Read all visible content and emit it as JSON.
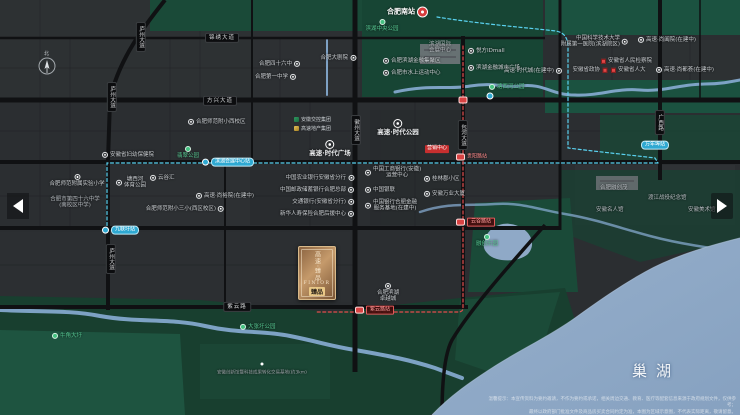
{
  "map": {
    "lake": "巢湖",
    "compass": "北",
    "disclaimer1": "温馨提示：本宣传资料为要约邀请，不作为要约或承诺，相关周边交通、教育、医疗等配套信息来源于政府规划文件，仅供参考；",
    "disclaimer2": "最终以政府部门批准文件及商品房买卖合同约定为准，本图为区域示意图，不代表实际距离，敬请留意。"
  },
  "project_card": {
    "vertical": "高速·臻品",
    "latin": "FINIOR",
    "badge": "臻品"
  },
  "legend": [
    {
      "icon": "green",
      "text": "安徽交控集团"
    },
    {
      "icon": "gold",
      "text": "高速地产集团"
    }
  ],
  "labels": [
    {
      "t": "rail",
      "a": "r",
      "x": 428,
      "y": 12,
      "text": "合肥南站"
    },
    {
      "t": "park-below",
      "a": "c",
      "x": 382,
      "y": 19,
      "text": "滨湖中央公园"
    },
    {
      "t": "park",
      "a": "l",
      "x": 489,
      "y": 87,
      "text": "塘西河公园"
    },
    {
      "t": "park-below",
      "a": "c",
      "x": 188,
      "y": 146,
      "text": "翡翠公园"
    },
    {
      "t": "park-below",
      "a": "c",
      "x": 487,
      "y": 234,
      "text": "融创乐园"
    },
    {
      "t": "park",
      "a": "l",
      "x": 240,
      "y": 327,
      "text": "大张圩公园"
    },
    {
      "t": "park",
      "a": "l",
      "x": 52,
      "y": 336,
      "text": "牛角大圩"
    },
    {
      "t": "proj",
      "a": "c",
      "x": 330,
      "y": 140,
      "text": "高速·时代广场"
    },
    {
      "t": "proj",
      "a": "c",
      "x": 398,
      "y": 119,
      "text": "高速·时代公园"
    },
    {
      "t": "red-badge",
      "a": "c",
      "x": 437,
      "y": 149,
      "text": "营销中心"
    },
    {
      "t": "poi",
      "a": "r",
      "x": 356,
      "y": 58,
      "text": "合肥大剧院"
    },
    {
      "t": "poi",
      "a": "r",
      "x": 300,
      "y": 64,
      "text": "合肥四十六中"
    },
    {
      "t": "poi",
      "a": "r",
      "x": 296,
      "y": 77,
      "text": "合肥第一中学"
    },
    {
      "t": "poi",
      "a": "l",
      "x": 468,
      "y": 51,
      "text": "悦方IDmall"
    },
    {
      "t": "poi",
      "a": "l",
      "x": 468,
      "y": 68,
      "text": "滨湖金融城市广场"
    },
    {
      "t": "poi",
      "a": "l",
      "x": 383,
      "y": 61,
      "text": "合肥滨湖金融集聚区"
    },
    {
      "t": "poi",
      "a": "l",
      "x": 383,
      "y": 73,
      "text": "合肥市水上运动中心"
    },
    {
      "t": "plain-lines",
      "a": "c",
      "x": 440,
      "y": 48,
      "lines": [
        "滨湖国际",
        "会展中心"
      ]
    },
    {
      "t": "poi",
      "a": "r",
      "x": 562,
      "y": 71,
      "text": "高速·时代城(在建中)"
    },
    {
      "t": "poi-lines",
      "a": "r",
      "x": 628,
      "y": 42,
      "lines": [
        "中国科学技术大学",
        "附属第一医院(滨湖院区)"
      ]
    },
    {
      "t": "poi",
      "a": "l",
      "x": 638,
      "y": 40,
      "text": "高速·尚阖院(在建中)"
    },
    {
      "t": "poi",
      "a": "l",
      "x": 656,
      "y": 70,
      "text": "高速·尚都荟(在建中)"
    },
    {
      "t": "gov",
      "a": "l",
      "x": 601,
      "y": 61,
      "text": "安徽省人民检察院"
    },
    {
      "t": "gov",
      "a": "r",
      "x": 607,
      "y": 70,
      "text": "安徽省政协"
    },
    {
      "t": "gov",
      "a": "l",
      "x": 611,
      "y": 70,
      "text": "安徽省人大"
    },
    {
      "t": "poi",
      "a": "l",
      "x": 188,
      "y": 122,
      "text": "合肥师范附小西校区"
    },
    {
      "t": "poi",
      "a": "l",
      "x": 102,
      "y": 155,
      "text": "安徽省妇幼保健院"
    },
    {
      "t": "poi",
      "a": "l",
      "x": 150,
      "y": 178,
      "text": "云谷汇"
    },
    {
      "t": "poi-lines",
      "a": "l",
      "x": 116,
      "y": 183,
      "lines": [
        "塘西河",
        "体育公园"
      ]
    },
    {
      "t": "poi",
      "a": "l",
      "x": 196,
      "y": 196,
      "text": "高速·尚裕院(在建中)"
    },
    {
      "t": "poi",
      "a": "r",
      "x": 224,
      "y": 209,
      "text": "合肥师范附小三小(西区校区)"
    },
    {
      "t": "poi-below",
      "a": "c",
      "x": 77,
      "y": 174,
      "lines": [
        "合肥师范附属实验小学"
      ]
    },
    {
      "t": "plain-lines",
      "a": "c",
      "x": 75,
      "y": 203,
      "lines": [
        "合肥市第四十六中学",
        "(南校区中学)"
      ]
    },
    {
      "t": "poi",
      "a": "r",
      "x": 354,
      "y": 178,
      "text": "中国农业银行安徽省分行"
    },
    {
      "t": "poi",
      "a": "r",
      "x": 354,
      "y": 190,
      "text": "中国邮政储蓄银行合肥总部"
    },
    {
      "t": "poi",
      "a": "r",
      "x": 354,
      "y": 202,
      "text": "交通银行(安徽省分行)"
    },
    {
      "t": "poi",
      "a": "r",
      "x": 354,
      "y": 214,
      "text": "新华人寿保险合肥后援中心"
    },
    {
      "t": "poi-lines",
      "a": "l",
      "x": 365,
      "y": 173,
      "lines": [
        "中国工商银行(安徽)",
        "运营中心"
      ]
    },
    {
      "t": "poi",
      "a": "l",
      "x": 365,
      "y": 190,
      "text": "中国银联"
    },
    {
      "t": "poi-lines",
      "a": "l",
      "x": 365,
      "y": 206,
      "lines": [
        "中国银行合肥金融",
        "服务基地(在建中)"
      ]
    },
    {
      "t": "poi",
      "a": "l",
      "x": 424,
      "y": 179,
      "text": "桂林郡小区"
    },
    {
      "t": "poi",
      "a": "l",
      "x": 424,
      "y": 194,
      "text": "安徽万业大厦"
    },
    {
      "t": "poi-below",
      "a": "c",
      "x": 388,
      "y": 283,
      "lines": [
        "合肥滨湖",
        "卓越城"
      ]
    },
    {
      "t": "plain",
      "a": "l",
      "x": 600,
      "y": 188,
      "text": "合肥融创茂"
    },
    {
      "t": "plain",
      "a": "l",
      "x": 596,
      "y": 210,
      "text": "安徽名人馆"
    },
    {
      "t": "plain",
      "a": "l",
      "x": 648,
      "y": 198,
      "text": "渡江战役纪念馆"
    },
    {
      "t": "plain",
      "a": "l",
      "x": 688,
      "y": 210,
      "text": "安徽美术馆"
    },
    {
      "t": "dot-white",
      "a": "c",
      "x": 262,
      "y": 364
    },
    {
      "t": "plain tiny",
      "a": "c",
      "x": 262,
      "y": 373,
      "text": "安徽创新馆暨科技成果转化交易基地(约3km)"
    },
    {
      "t": "m-blue",
      "a": "l",
      "x": 202,
      "y": 162,
      "text": "滨湖会展中心站"
    },
    {
      "t": "m-blue",
      "a": "l",
      "x": 102,
      "y": 230,
      "text": "九联圩站"
    },
    {
      "t": "m-blue-pill",
      "a": "c",
      "x": 655,
      "y": 145,
      "text": "万年埠站"
    },
    {
      "t": "m-blue-icon",
      "a": "c",
      "x": 490,
      "y": 96
    },
    {
      "t": "m-red-icon",
      "a": "c",
      "x": 463,
      "y": 100
    },
    {
      "t": "m-red-label",
      "a": "l",
      "x": 456,
      "y": 157,
      "text": "贵阳路站"
    },
    {
      "t": "m-red-pill",
      "a": "l",
      "x": 456,
      "y": 222,
      "text": "云谷路站"
    },
    {
      "t": "m-red-pill",
      "a": "l",
      "x": 355,
      "y": 310,
      "text": "紫云路站"
    },
    {
      "t": "road-h",
      "a": "c",
      "x": 222,
      "y": 38,
      "text": "锦绣大道"
    },
    {
      "t": "road-h",
      "a": "c",
      "x": 220,
      "y": 101,
      "text": "方兴大道"
    },
    {
      "t": "road-h",
      "a": "c",
      "x": 237,
      "y": 307,
      "text": "紫云路"
    },
    {
      "t": "road-v",
      "a": "c",
      "x": 141,
      "y": 22,
      "text": "庐州大道"
    },
    {
      "t": "road-v",
      "a": "c",
      "x": 112,
      "y": 82,
      "text": "庐州大道"
    },
    {
      "t": "road-v",
      "a": "c",
      "x": 111,
      "y": 244,
      "text": "庐州大道"
    },
    {
      "t": "road-v",
      "a": "c",
      "x": 356,
      "y": 115,
      "text": "徽州大道"
    },
    {
      "t": "road-v",
      "a": "c",
      "x": 463,
      "y": 120,
      "text": "包河大道"
    },
    {
      "t": "road-v",
      "a": "c",
      "x": 660,
      "y": 110,
      "text": "广西路"
    }
  ]
}
